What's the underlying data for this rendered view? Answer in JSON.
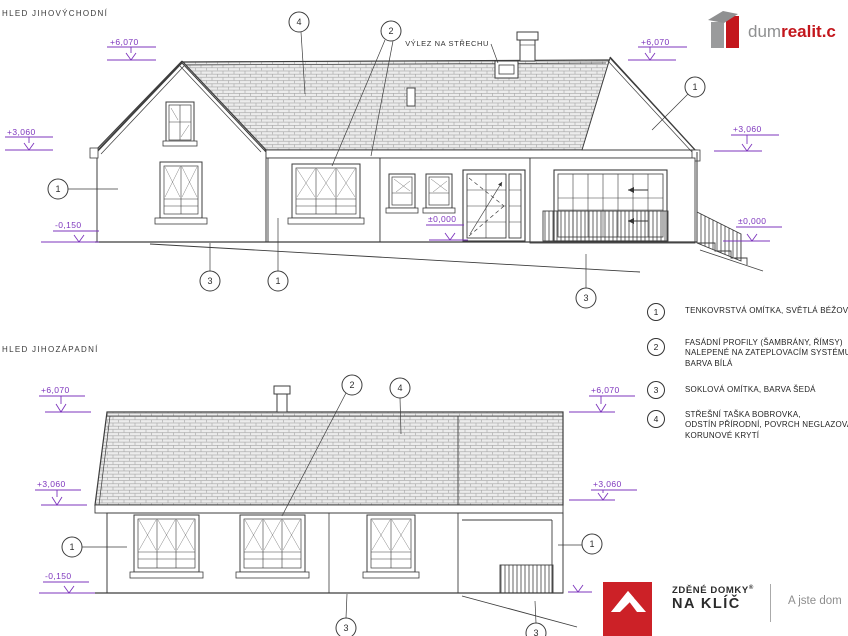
{
  "se": {
    "title": "HLED JIHOVÝCHODNÍ",
    "roof_access": "VÝLEZ NA STŘECHU",
    "dims": {
      "ridge_left": "+6,070",
      "ridge_right": "+6,070",
      "eave_left": "+3,060",
      "eave_right": "+3,060",
      "plinth_left": "-0,150",
      "floor_center": "±0,000",
      "floor_right": "±0,000"
    },
    "callouts": {
      "roof": "4",
      "profiles": "2",
      "wall_left": "1",
      "gable_right": "1",
      "plinth": "3",
      "wall_base": "1",
      "terrain": "3"
    }
  },
  "sw": {
    "title": "HLED JIHOZÁPADNÍ",
    "dims": {
      "ridge_left": "+6,070",
      "ridge_right": "+6,070",
      "eave_left": "+3,060",
      "eave_right": "+3,060",
      "plinth_left": "-0,150"
    },
    "callouts": {
      "profiles": "2",
      "roof": "4",
      "wall_left": "1",
      "porch": "1",
      "plinth": "3",
      "terrain": "3"
    }
  },
  "legend": {
    "items": [
      {
        "num": "1",
        "lines": [
          "TENKOVRSTVÁ OMÍTKA, SVĚTLÁ BÉŽOVO-ŠEDÁ"
        ]
      },
      {
        "num": "2",
        "lines": [
          "FASÁDNÍ PROFILY (ŠAMBRÁNY, ŘÍMSY)",
          "NALEPENÉ NA ZATEPLOVACÍM SYSTÉMU",
          "BARVA BÍLÁ"
        ]
      },
      {
        "num": "3",
        "lines": [
          "SOKLOVÁ OMÍTKA, BARVA ŠEDÁ"
        ]
      },
      {
        "num": "4",
        "lines": [
          "STŘEŠNÍ TAŠKA BOBROVKA,",
          "ODSTÍN PŘÍRODNÍ, POVRCH NEGLAZOVANÝ,",
          "KORUNOVÉ KRYTÍ"
        ]
      }
    ]
  },
  "brand_top": {
    "gray": "dum",
    "red": "realit.c"
  },
  "brand_bottom": {
    "name_top": "ZDĚNÉ DOMKY",
    "reg": "®",
    "name_bottom": "NA KLÍČ",
    "tagline": "A jste dom"
  },
  "colors": {
    "dimension": "#7d35bd",
    "drawing_line": "#3d3d3d",
    "brand_red": "#c3161c",
    "brand_gray": "#8f9091",
    "logo_red": "#cc2127"
  }
}
